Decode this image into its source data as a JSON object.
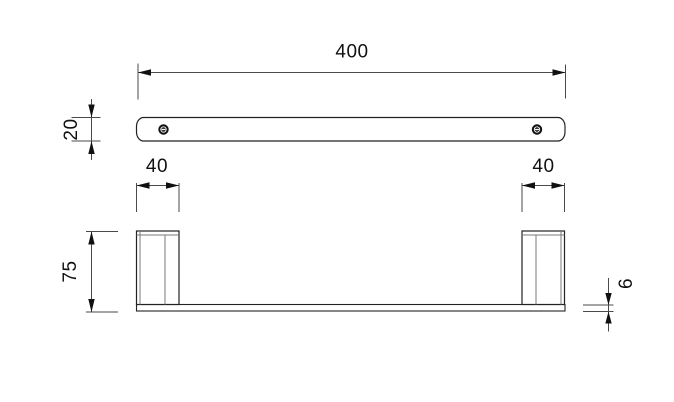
{
  "page": {
    "background": "#ffffff",
    "outline_color": "#222222",
    "secondary_line_color": "#7a7a7a",
    "dimension_line_color": "#4a4a4a",
    "text_color": "#111111"
  },
  "dimensions": {
    "overall_length": "400",
    "bar_depth": "20",
    "post_width_left": "40",
    "post_width_right": "40",
    "post_height": "75",
    "rail_thickness": "6"
  },
  "icons": {
    "screw_left": "screw-head-icon",
    "screw_right": "screw-head-icon"
  }
}
